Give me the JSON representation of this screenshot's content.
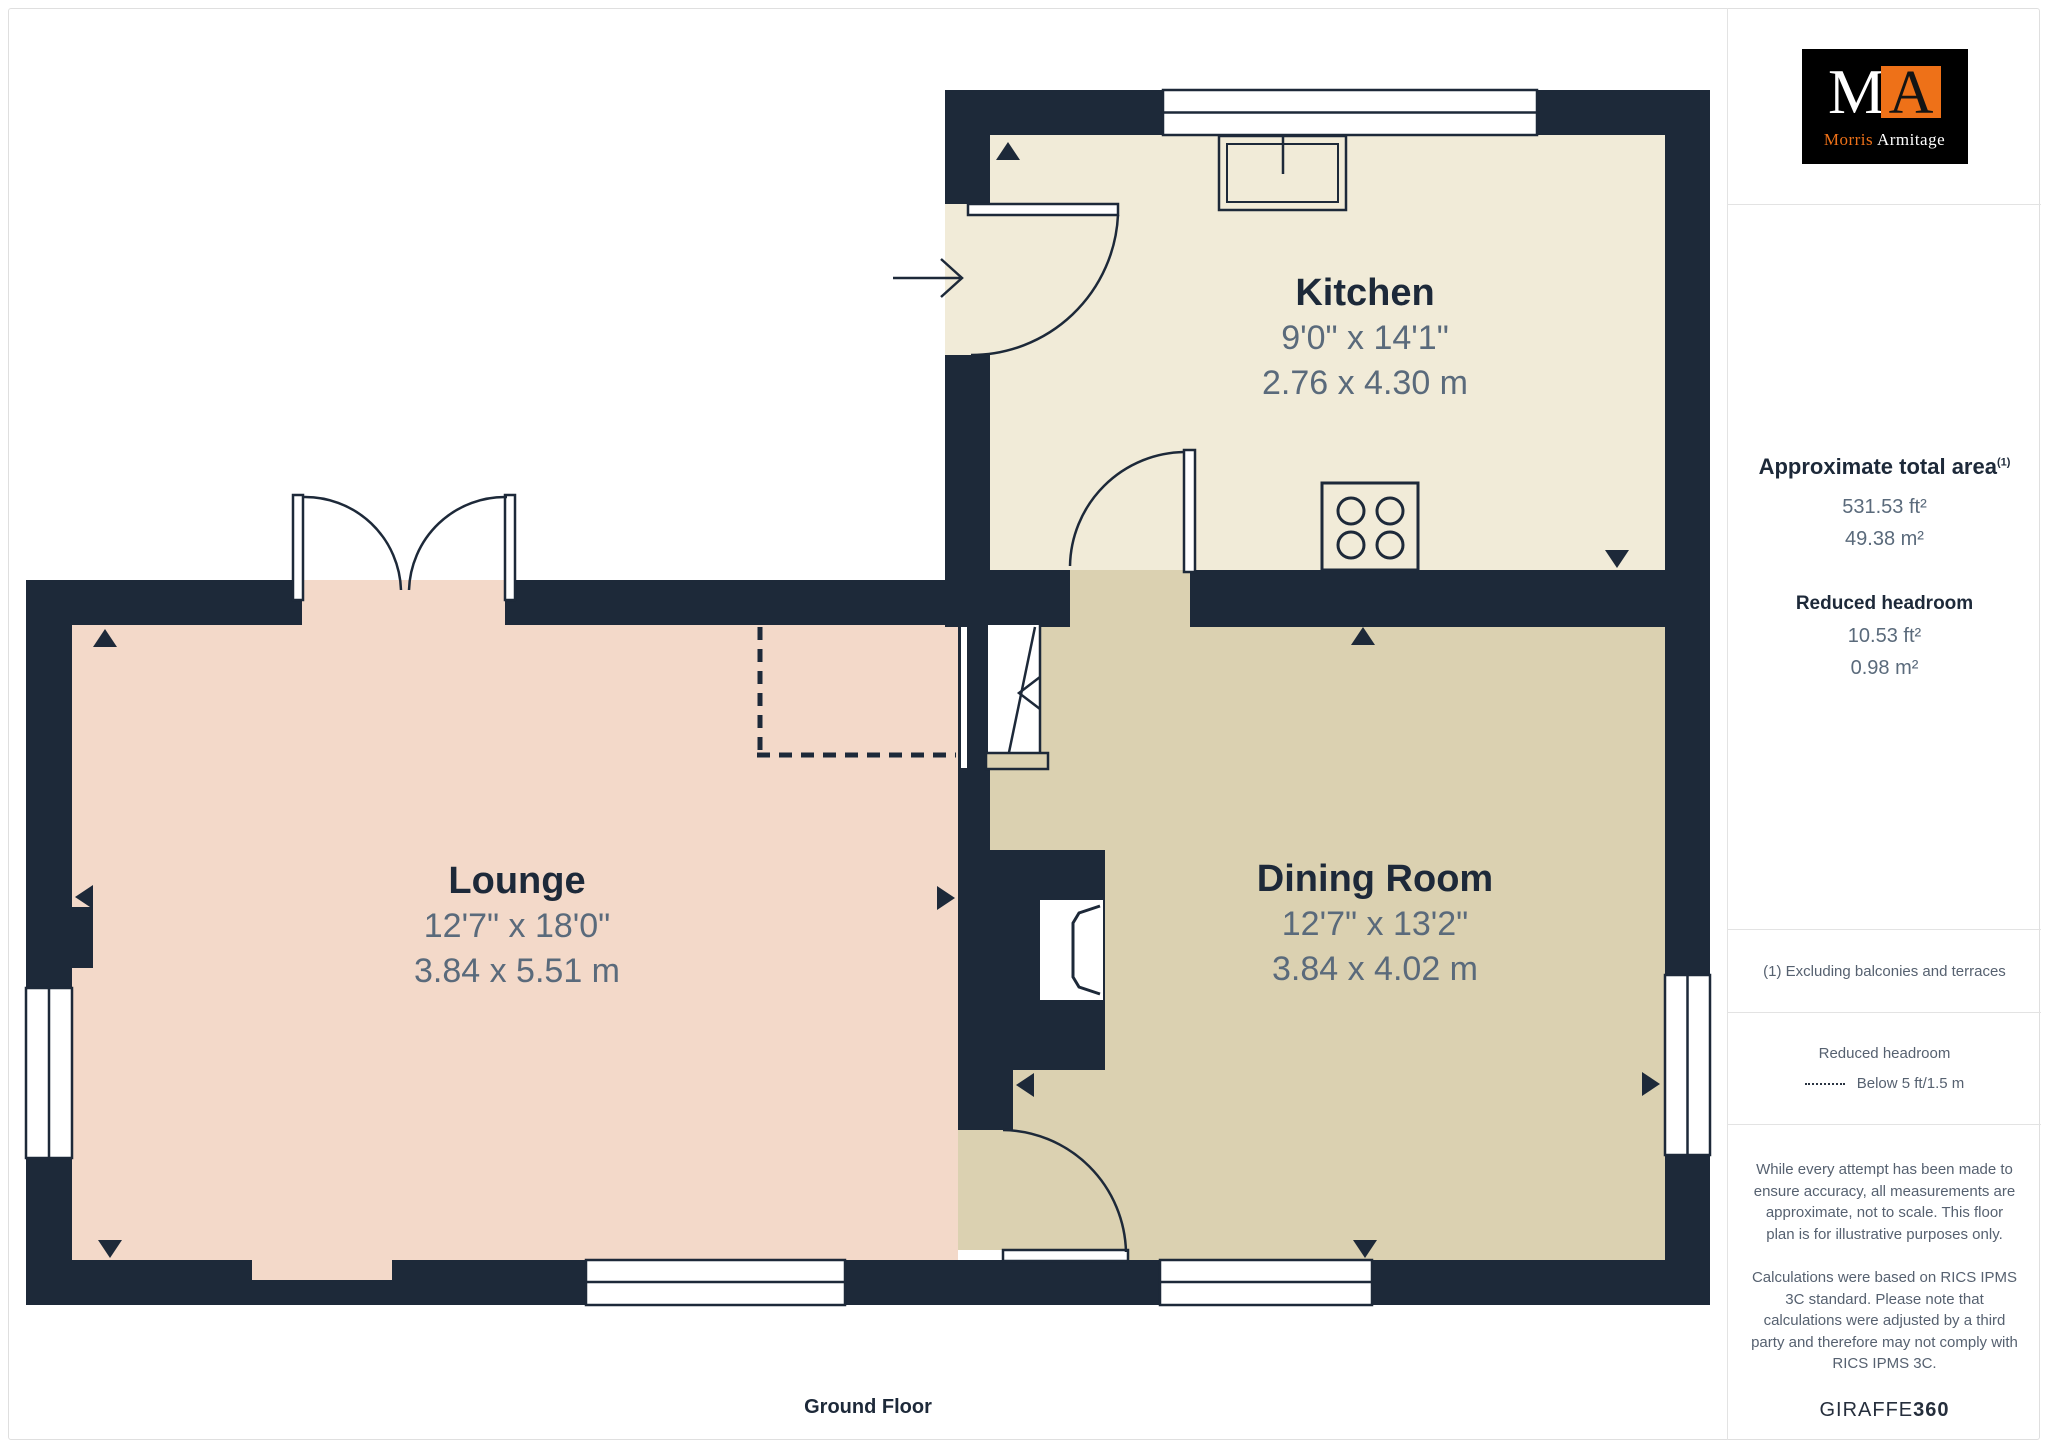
{
  "plan": {
    "floor_label": "Ground Floor",
    "rooms": {
      "kitchen": {
        "name": "Kitchen",
        "dims_imperial": "9'0\" x 14'1\"",
        "dims_metric": "2.76 x 4.30 m"
      },
      "lounge": {
        "name": "Lounge",
        "dims_imperial": "12'7\" x 18'0\"",
        "dims_metric": "3.84 x 5.51 m"
      },
      "dining": {
        "name": "Dining Room",
        "dims_imperial": "12'7\" x 13'2\"",
        "dims_metric": "3.84 x 4.02 m"
      }
    }
  },
  "sidebar": {
    "logo": {
      "monogram_m": "M",
      "monogram_a": "A",
      "name_first": "Morris",
      "name_last": "Armitage"
    },
    "area": {
      "title": "Approximate total area",
      "title_superscript": "(1)",
      "total_ft": "531.53 ft²",
      "total_m": "49.38 m²",
      "reduced_title": "Reduced headroom",
      "reduced_ft": "10.53 ft²",
      "reduced_m": "0.98 m²"
    },
    "footnote": "(1) Excluding balconies and terraces",
    "legend": {
      "title": "Reduced headroom",
      "item": "Below 5 ft/1.5 m"
    },
    "disclaimer1": "While every attempt has been made to ensure accuracy, all measurements are approximate, not to scale. This floor plan is for illustrative purposes only.",
    "disclaimer2": "Calculations were based on RICS IPMS 3C standard. Please note that calculations were adjusted by a third party and therefore may not comply with RICS IPMS 3C.",
    "brand_name": "GIRAFFE",
    "brand_suffix": "360"
  },
  "colors": {
    "wall": "#1D2939",
    "kitchen_floor": "#F1EBD8",
    "lounge_floor": "#F3D9C9",
    "dining_floor": "#DBD1B1",
    "dim_text": "#5A6A7B",
    "logo_orange": "#EE7118",
    "divider": "#E3E3E3"
  }
}
